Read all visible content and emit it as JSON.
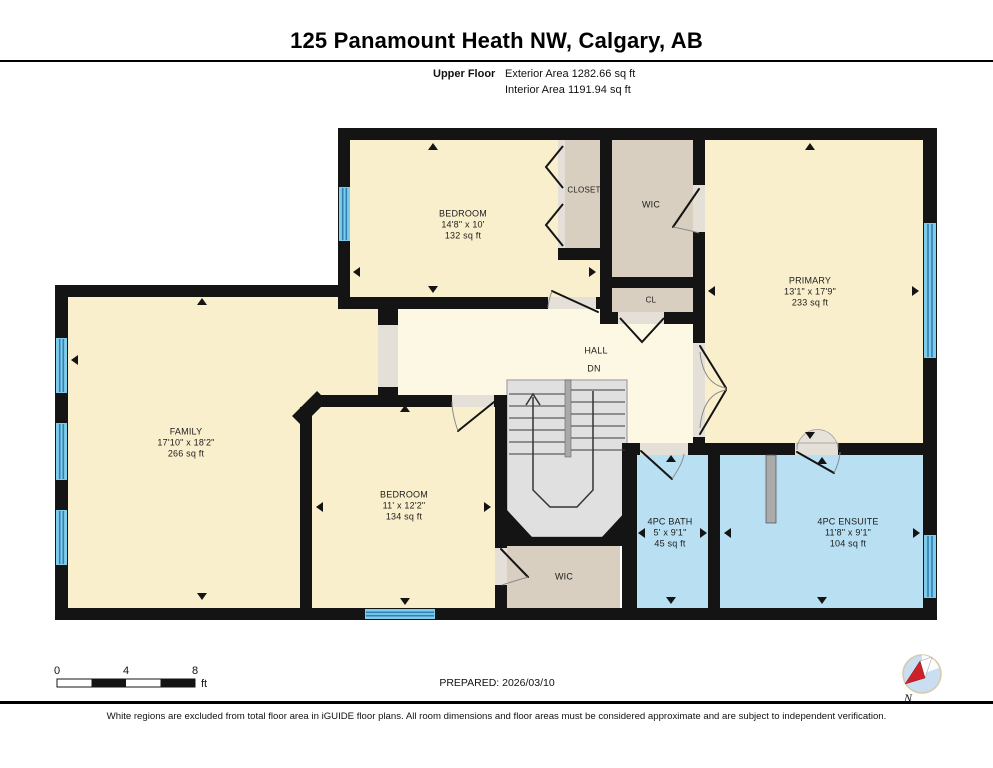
{
  "header": {
    "title": "125 Panamount Heath NW, Calgary, AB",
    "floor_label": "Upper Floor",
    "exterior_area": "Exterior Area 1282.66 sq ft",
    "interior_area": "Interior Area 1191.94 sq ft"
  },
  "rooms": {
    "bedroom_top": {
      "name": "BEDROOM",
      "dims": "14'8\" x 10'",
      "area": "132 sq ft"
    },
    "closet": {
      "name": "CLOSET"
    },
    "wic_top": {
      "name": "WIC"
    },
    "cl": {
      "name": "CL"
    },
    "primary": {
      "name": "PRIMARY",
      "dims": "13'1\" x 17'9\"",
      "area": "233 sq ft"
    },
    "hall": {
      "name": "HALL",
      "stairs_label": "DN"
    },
    "family": {
      "name": "FAMILY",
      "dims": "17'10\" x 18'2\"",
      "area": "266 sq ft"
    },
    "bedroom_bottom": {
      "name": "BEDROOM",
      "dims": "11' x 12'2\"",
      "area": "134 sq ft"
    },
    "wic_bottom": {
      "name": "WIC"
    },
    "bath": {
      "name": "4PC BATH",
      "dims": "5' x 9'1\"",
      "area": "45 sq ft"
    },
    "ensuite": {
      "name": "4PC ENSUITE",
      "dims": "11'8\" x 9'1\"",
      "area": "104 sq ft"
    }
  },
  "footer": {
    "scale": {
      "t0": "0",
      "t4": "4",
      "t8": "8",
      "unit": "ft"
    },
    "prepared": "PREPARED: 2026/03/10",
    "compass_label": "N",
    "disclaimer": "White regions are excluded from total floor area in iGUIDE floor plans. All room dimensions and floor areas must be considered approximate and are subject to independent verification."
  },
  "colors": {
    "wall": "#141414",
    "room": "#FAEFCD",
    "hall": "#FDF8E4",
    "closet": "#D9CFC0",
    "bath": "#B9DFF2",
    "window": "#7ECBEA",
    "window_line": "#2E80B6",
    "stair": "#E0E0E0",
    "needle_red": "#CE2029",
    "compass_blue": "#C9DEF0"
  }
}
